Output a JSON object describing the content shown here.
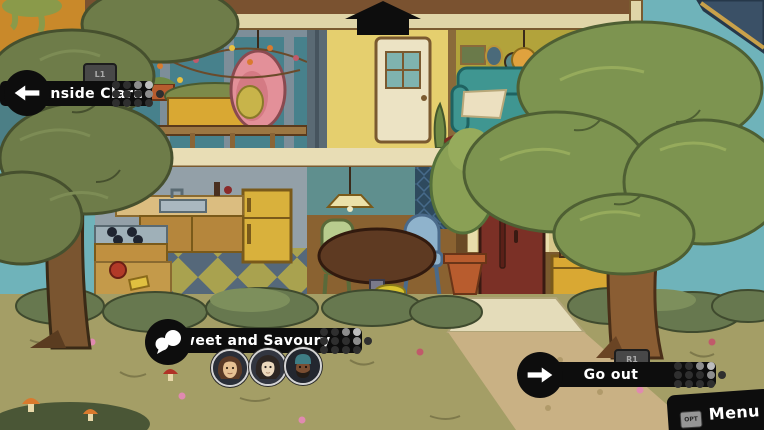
{
  "screen": {
    "type": "game-scene",
    "description": "cutaway dollhouse view of a two-storey home with garden and trees"
  },
  "navigation": {
    "up_indicator": {
      "icon": "arrow-up-icon"
    },
    "left": {
      "label": "Inside Clara",
      "button_hint": "L1",
      "icon": "arrow-left-icon"
    },
    "right": {
      "label": "Go out",
      "button_hint": "R1",
      "icon": "arrow-right-icon"
    }
  },
  "conversation": {
    "label": "Sweet and Savoury",
    "icon": "speech-bubbles-icon",
    "portraits": [
      {
        "name": "woman-brown-hair"
      },
      {
        "name": "woman-dark-hair"
      },
      {
        "name": "man-teal-beanie"
      }
    ]
  },
  "menu": {
    "label": "Menu",
    "button_hint": "OPT"
  },
  "colors": {
    "banner_bg": "#0d0d0d",
    "banner_text": "#ffffff",
    "hint_badge_bg": "#484848",
    "hint_badge_text": "#a9a9a9",
    "sky": "#6fb3ba",
    "door": "#7b3026",
    "couch": "#3f9691",
    "egg_chair": "#e39099"
  }
}
